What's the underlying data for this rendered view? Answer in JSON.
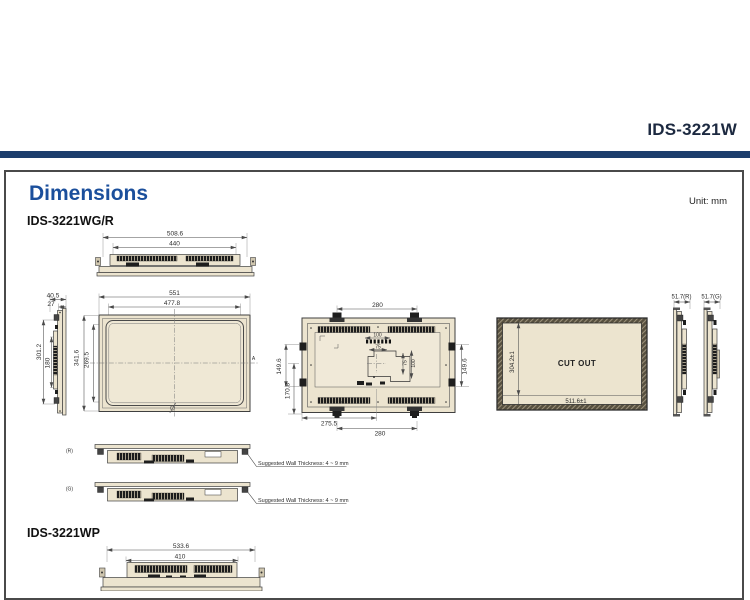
{
  "header": {
    "product_title": "IDS-3221W"
  },
  "page": {
    "title": "Dimensions",
    "unit": "Unit: mm"
  },
  "colors": {
    "accent_blue": "#1b4f9c",
    "navy_bar": "#1d3e6d",
    "drawing_fill": "#ece4cf"
  },
  "wgr": {
    "label": "IDS-3221WG/R",
    "top_view": {
      "width_outer": "508.6",
      "width_inner": "440"
    },
    "side_view": {
      "depth": "40.5",
      "depth_front": "27",
      "height": "301.2",
      "height_inner": "180"
    },
    "front_view": {
      "width_outer": "551",
      "width_glass": "477.8",
      "height_outer": "341.6",
      "height_glass": "269.5",
      "section_mark": "A"
    },
    "rear_view": {
      "mount_width_top": "280",
      "mount_height_left": "149.6",
      "mount_offset_left": "170.8",
      "mount_height_right": "149.6",
      "offset_bottom": "275.5",
      "mount_width_bottom": "280",
      "vesa_width_100": "100",
      "vesa_width_75": "75",
      "vesa_height_75": "75",
      "vesa_height_100": "100"
    },
    "cutout": {
      "label": "CUT OUT",
      "height": "304.2±1",
      "width": "511.6±1"
    },
    "profiles": {
      "right": "51.7(R)",
      "glass": "51.7(G)"
    },
    "wall_sections": [
      {
        "tag": "(R)",
        "note": "Suggested Wall Thickness: 4 ~ 9 mm"
      },
      {
        "tag": "(G)",
        "note": "Suggested Wall Thickness: 4 ~ 9 mm"
      }
    ]
  },
  "wp": {
    "label": "IDS-3221WP",
    "top_view": {
      "width_outer": "533.6",
      "width_inner": "410"
    }
  }
}
